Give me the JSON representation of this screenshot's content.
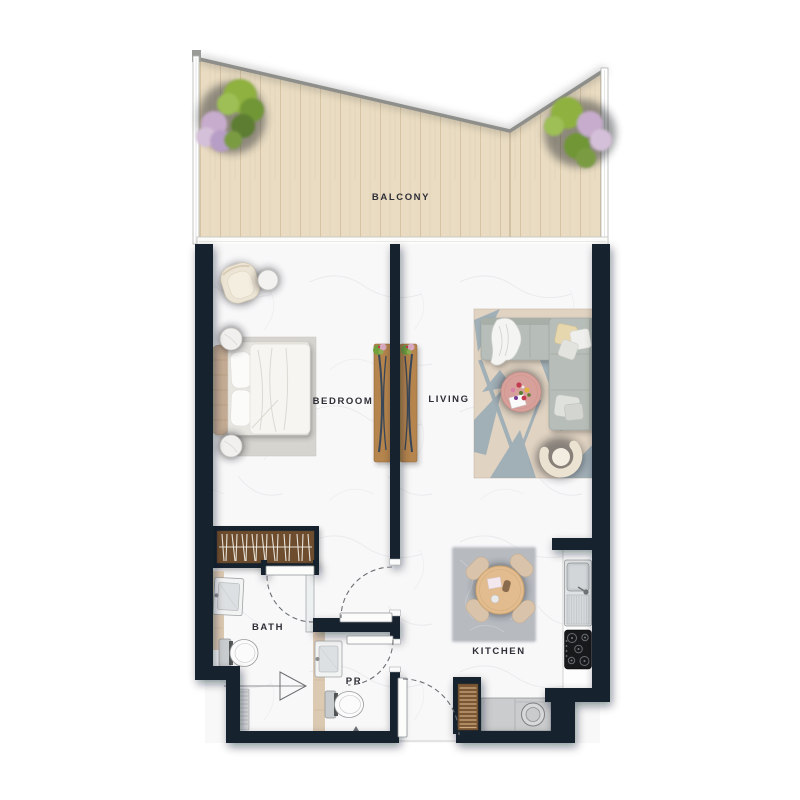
{
  "floor_plan": {
    "labels": {
      "balcony": "BALCONY",
      "bedroom": "BEDROOM",
      "living": "LIVING",
      "bath": "BATH",
      "powder_room": "PR",
      "kitchen": "KITCHEN"
    },
    "colors": {
      "wall": "#15222f",
      "balcony_wood": "#e9dcc2",
      "interior_floor": "#f8f8f9",
      "wood_furniture": "#b5854e",
      "closet_interior": "#6e4e2e",
      "sofa": "#b7bdb8",
      "living_rug_base": "#e0d3c2",
      "living_rug_accent": "#8da4b4",
      "coffee_table": "#d8a09a",
      "dining_table": "#e2bc8e",
      "kitchen_rug": "#b4b8be",
      "bed_headboard": "#c3ab93",
      "tree_green": "#85ab41",
      "tree_lilac": "#c7accd"
    }
  }
}
